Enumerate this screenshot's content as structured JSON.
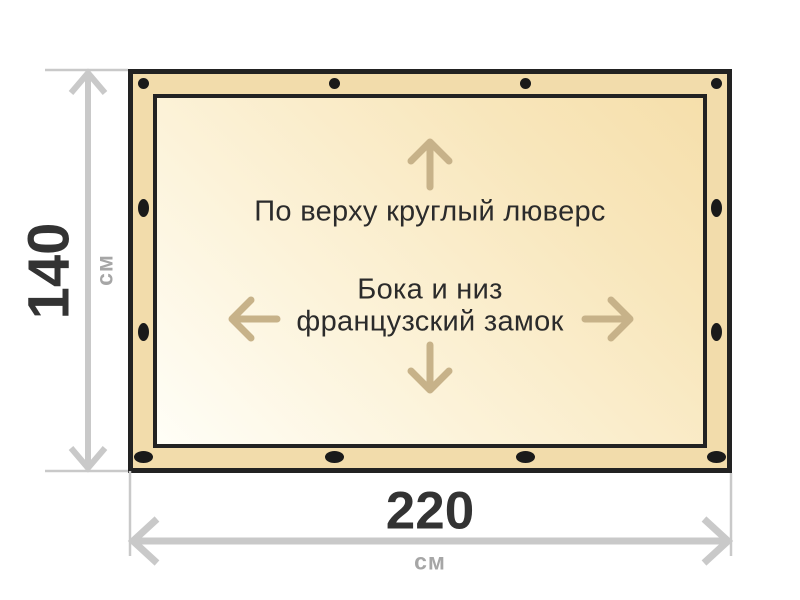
{
  "diagram": {
    "type": "product-dimension-diagram",
    "annotations": {
      "top_edge": "По верху круглый люверс",
      "center_line1": "Бока и низ",
      "center_line2": "французский замок"
    },
    "dimensions": {
      "height": {
        "value": "140",
        "unit": "см"
      },
      "width": {
        "value": "220",
        "unit": "см"
      }
    },
    "grommets": {
      "count": 12
    },
    "colors": {
      "panel_border": "#222222",
      "panel_band": "#f2dcab",
      "panel_fill_light": "#fffef7",
      "panel_fill_dark": "#f6dfab",
      "grommet": "#1a1a1a",
      "inner_arrows": "#c7b289",
      "dimension_lines": "#c9c9c9",
      "dimension_numbers": "#333333",
      "dimension_units": "#a6a6a6",
      "annotation_text": "#2b2b2b",
      "background": "#ffffff"
    }
  }
}
